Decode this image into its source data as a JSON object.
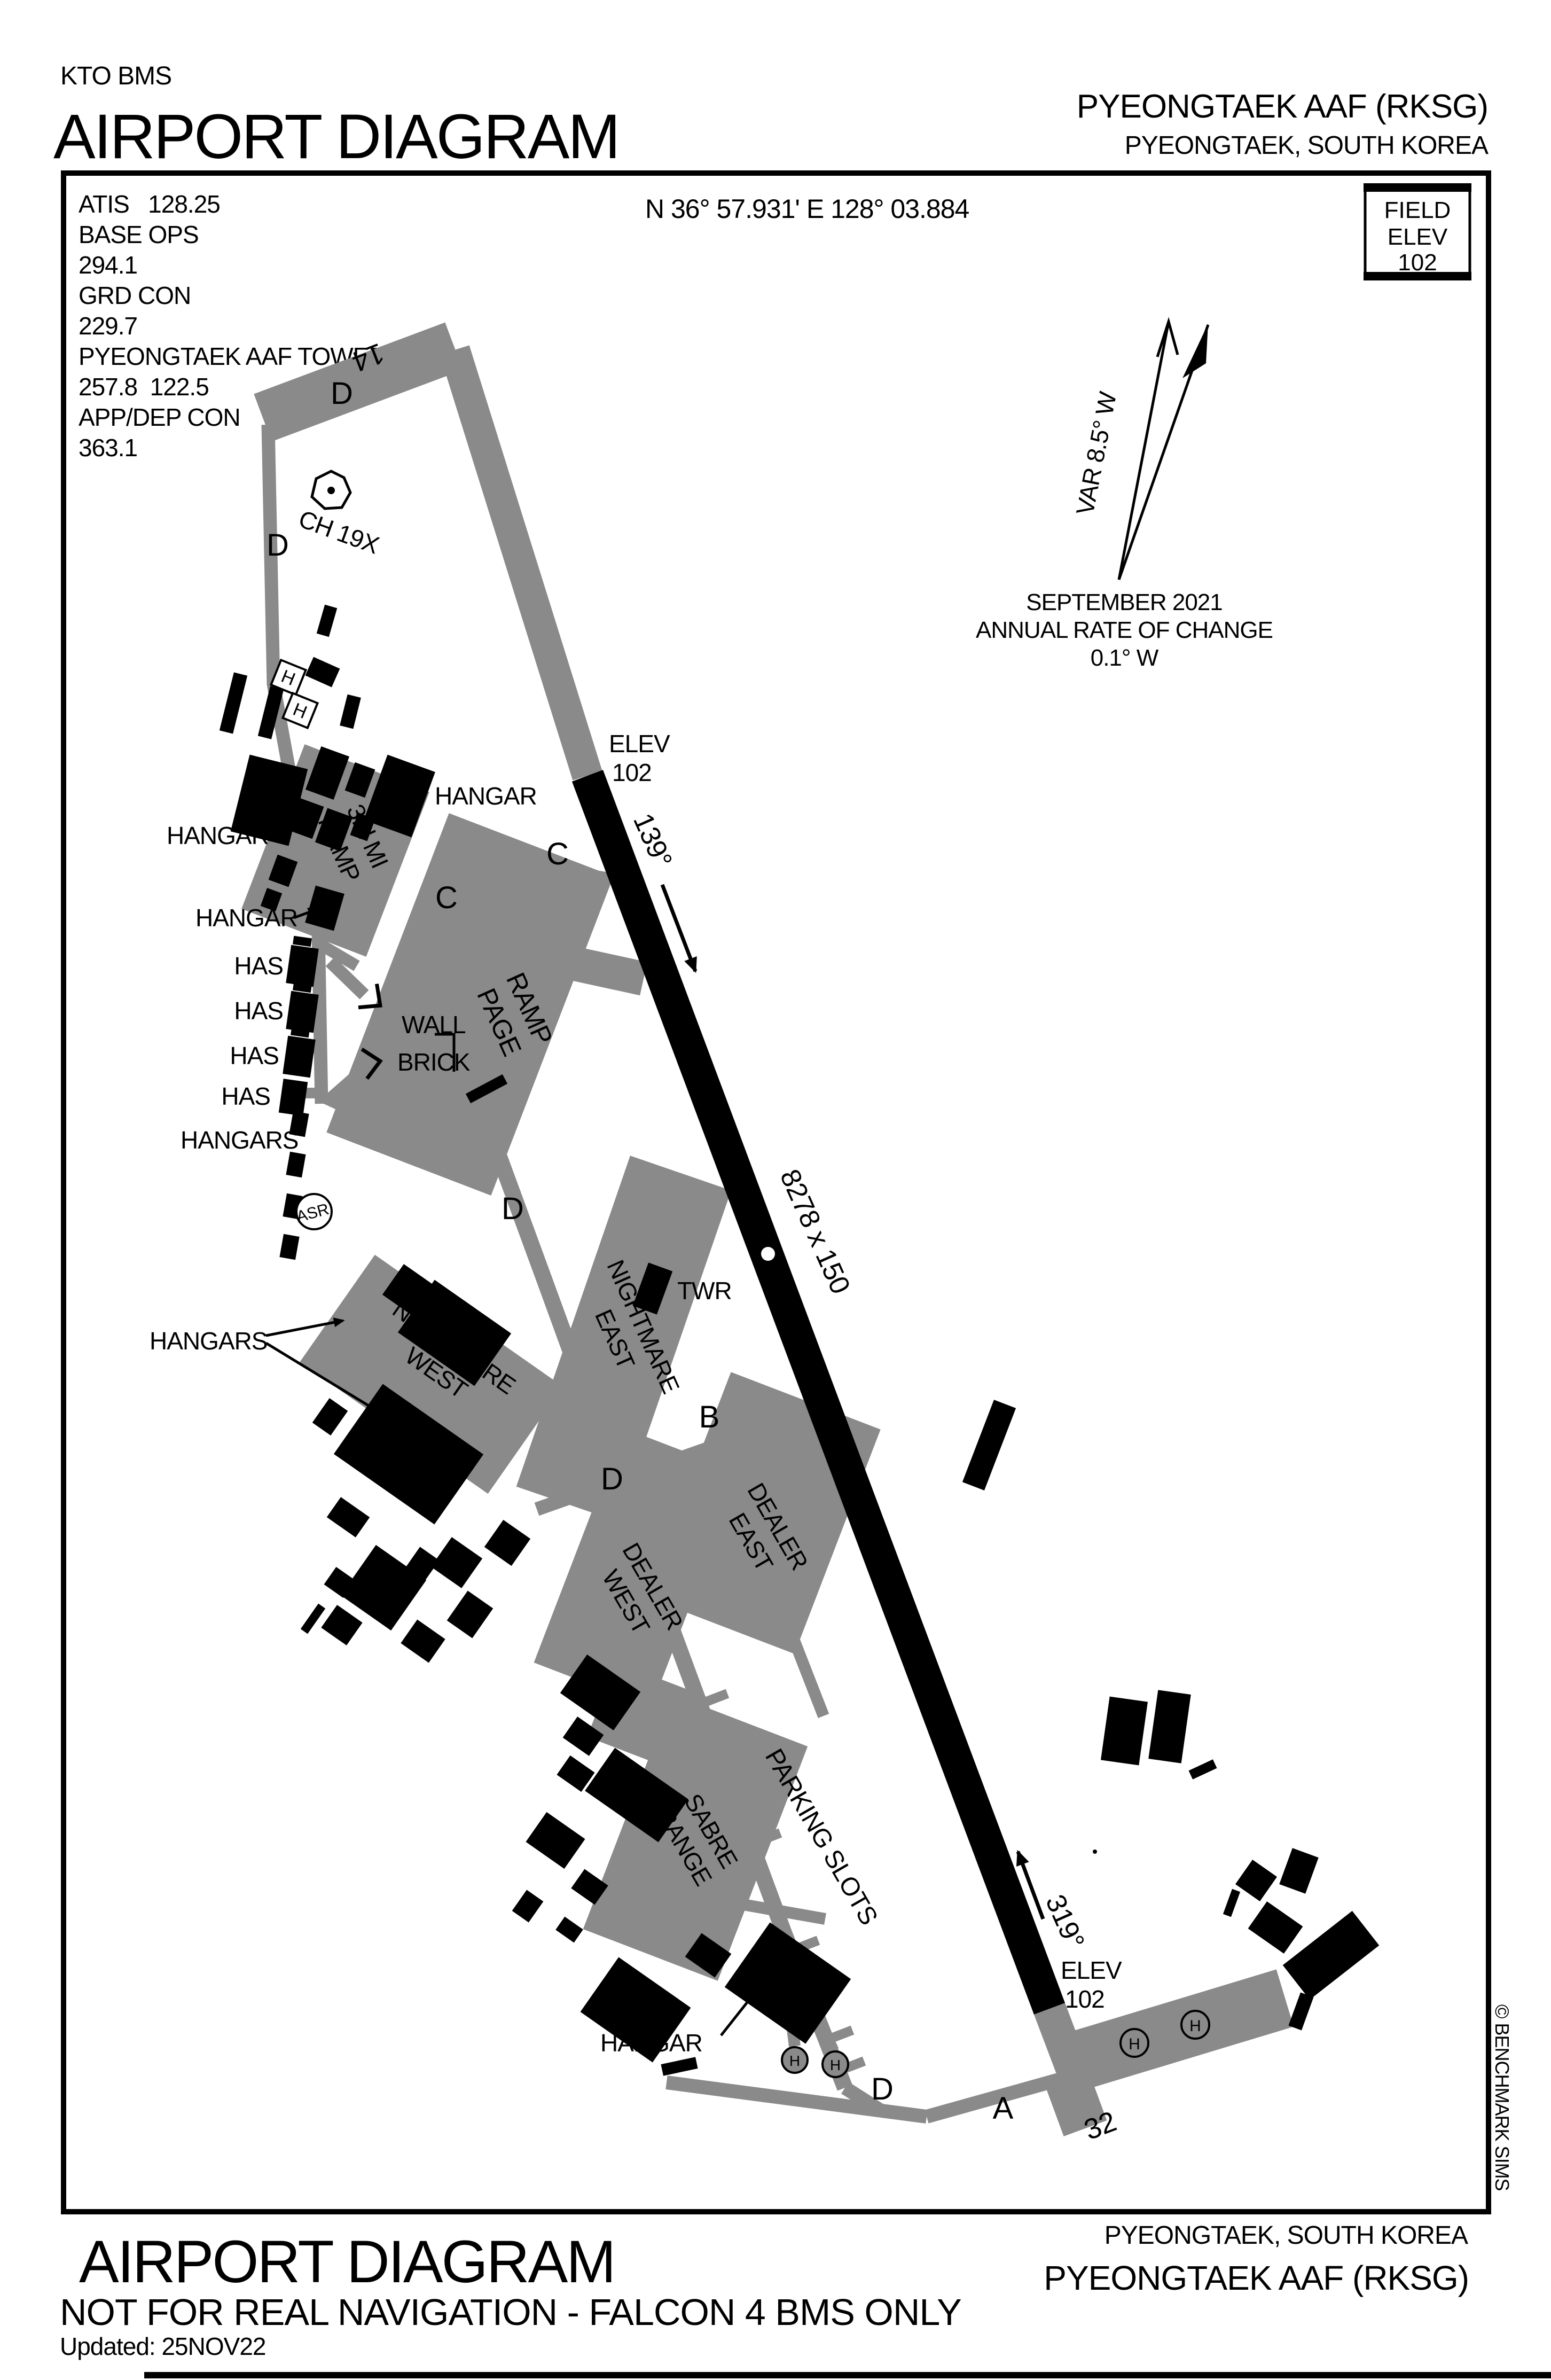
{
  "page": {
    "background": "#ffffff",
    "ink": "#000000",
    "pavement_gray": "#8a8a8a"
  },
  "header": {
    "program": "KTO BMS",
    "title": "AIRPORT DIAGRAM",
    "airport_name": "PYEONGTAEK AAF (RKSG)",
    "airport_location": "PYEONGTAEK, SOUTH KOREA"
  },
  "comms": {
    "lines": [
      "ATIS   128.25",
      "BASE OPS",
      "294.1",
      "GRD CON",
      "229.7",
      "PYEONGTAEK AAF TOWER",
      "257.8  122.5",
      "APP/DEP CON",
      "363.1"
    ]
  },
  "position": {
    "coordinates": "N 36° 57.931' E 128° 03.884"
  },
  "field_elev": {
    "label_1": "FIELD",
    "label_2": "ELEV",
    "value": "102"
  },
  "variation": {
    "var_label": "VAR 8.5° W",
    "date": "SEPTEMBER 2021",
    "rate_line1": "ANNUAL RATE OF CHANGE",
    "rate_line2": "0.1° W"
  },
  "runway": {
    "number_14": "14",
    "number_32": "32",
    "heading_14": "139°",
    "heading_32": "319°",
    "size": "8278 x 150",
    "elev_label": "ELEV",
    "elev_value": "102"
  },
  "taxiways": {
    "a": "A",
    "b": "B",
    "c": "C",
    "d": "D"
  },
  "facilities": {
    "tower": "TWR",
    "asr": "ASR",
    "tacan_channel": "CH 19X",
    "helipad": "H",
    "hangar": "HANGAR",
    "hangars": "HANGARS",
    "has": "HAS",
    "wall": "WALL",
    "brick": "BRICK"
  },
  "ramps": {
    "third_mi": {
      "line1": "3rd MI",
      "line2": "RAMP"
    },
    "ramp_page": {
      "line1": "RAMP",
      "line2": "PAGE"
    },
    "nightmare_west": {
      "line1": "NIGHTMARE",
      "line2": "WEST"
    },
    "nightmare_east": {
      "line1": "NIGHTMARE",
      "line2": "EAST"
    },
    "dealer_west": {
      "line1": "DEALER",
      "line2": "WEST"
    },
    "dealer_east": {
      "line1": "DEALER",
      "line2": "EAST"
    },
    "sabre_range": {
      "line1": "SABRE",
      "line2": "RANGE"
    },
    "parking_slots": "PARKING SLOTS"
  },
  "footer": {
    "title": "AIRPORT DIAGRAM",
    "disclaimer": "NOT FOR REAL NAVIGATION - FALCON 4 BMS ONLY",
    "updated": "Updated: 25NOV22",
    "airport_location": "PYEONGTAEK, SOUTH KOREA",
    "airport_name": "PYEONGTAEK AAF (RKSG)"
  },
  "credits": {
    "copyright": "© BENCHMARK SIMS"
  }
}
